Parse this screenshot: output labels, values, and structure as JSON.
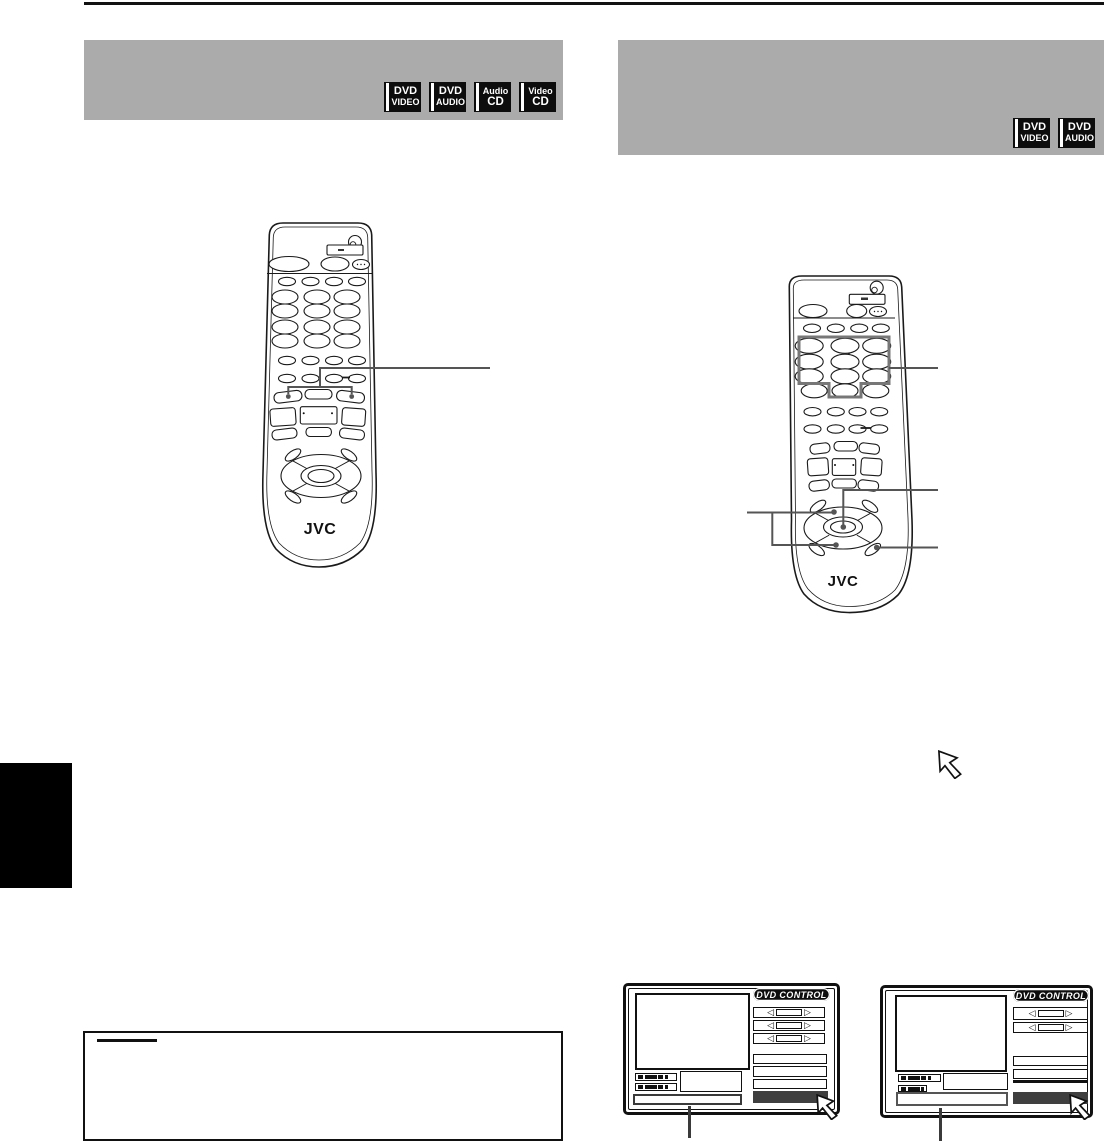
{
  "header_left": {
    "badges": [
      {
        "line1": "DVD",
        "line2": "VIDEO"
      },
      {
        "line1": "DVD",
        "line2": "AUDIO"
      },
      {
        "line1": "Audio",
        "line2": "CD"
      },
      {
        "line1": "Video",
        "line2": "CD"
      }
    ]
  },
  "header_right": {
    "badges": [
      {
        "line1": "DVD",
        "line2": "VIDEO"
      },
      {
        "line1": "DVD",
        "line2": "AUDIO"
      }
    ]
  },
  "remote_left": {
    "brand": "JVC"
  },
  "remote_right": {
    "brand": "JVC"
  },
  "osd_left": {
    "title": "DVD CONTROL"
  },
  "osd_right": {
    "title": "DVD CONTROL"
  },
  "icons": {
    "spin_left_arrow": "◁",
    "spin_right_arrow": "▷"
  },
  "colors": {
    "header_bar_gray": "#ababab",
    "callout_gray": "#555555",
    "highlight_gray": "#777777",
    "osd_dark_bar": "#3f3f3f",
    "ink": "#111111"
  }
}
